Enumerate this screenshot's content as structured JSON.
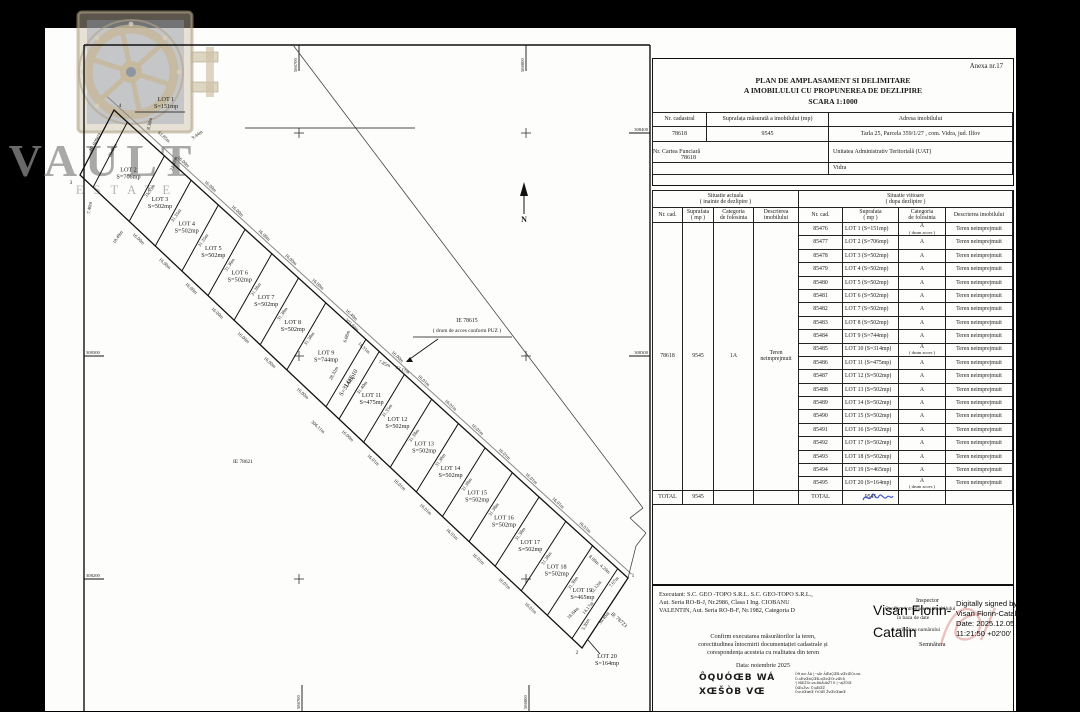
{
  "watermark": {
    "line1": "VAULT",
    "line2": "ESTATE"
  },
  "annex": "Anexa nr.17",
  "title": {
    "l1": "PLAN DE AMPLASAMENT SI DELIMITARE",
    "l2": "A IMOBILULUI CU PROPUNEREA DE DEZLIPIRE",
    "l3": "SCARA 1:1000"
  },
  "cadastral": {
    "h_nr": "Nr. cadastral",
    "h_sup": "Suprafața măsurată a imobilului (mp)",
    "h_adr": "Adresa imobilului",
    "nr": "78618",
    "sup": "9545",
    "adr": "Tarla 25,  Parcela 359/1/27 , com. Vidra, jud. Ilfov",
    "cf_label": "Nr. Cartea Funciară",
    "cf": "78618",
    "uat_label": "Unitatea Administrativ Teritorială (UAT)",
    "uat": "Vidra"
  },
  "table": {
    "actual_header": "Situatie actuala\n( inainte de dezlipire )",
    "future_header": "Situatie viitoare\n( dupa dezlipire )",
    "cols": [
      "Nr. cad.",
      "Suprafata\n( mp )",
      "Categoria\nde folosinta",
      "Descrierea imobilului"
    ],
    "actual": {
      "nr": "78618",
      "sup": "9545",
      "cat": "1A",
      "desc": "Teren neimprejmuit"
    },
    "rows": [
      {
        "nr": "85476",
        "lot": "LOT 1 (S=151mp)",
        "cat": "A",
        "cat2": "( drum acces )",
        "desc": "Teren neimprejmuit"
      },
      {
        "nr": "85477",
        "lot": "LOT 2 (S=706mp)",
        "cat": "A",
        "cat2": "",
        "desc": "Teren neimprejmuit"
      },
      {
        "nr": "85478",
        "lot": "LOT 3 (S=502mp)",
        "cat": "A",
        "cat2": "",
        "desc": "Teren neimprejmuit"
      },
      {
        "nr": "85479",
        "lot": "LOT 4 (S=502mp)",
        "cat": "A",
        "cat2": "",
        "desc": "Teren neimprejmuit"
      },
      {
        "nr": "85480",
        "lot": "LOT 5 (S=502mp)",
        "cat": "A",
        "cat2": "",
        "desc": "Teren neimprejmuit"
      },
      {
        "nr": "85481",
        "lot": "LOT 6 (S=502mp)",
        "cat": "A",
        "cat2": "",
        "desc": "Teren neimprejmuit"
      },
      {
        "nr": "85482",
        "lot": "LOT 7 (S=502mp)",
        "cat": "A",
        "cat2": "",
        "desc": "Teren neimprejmuit"
      },
      {
        "nr": "85483",
        "lot": "LOT 8 (S=502mp)",
        "cat": "A",
        "cat2": "",
        "desc": "Teren neimprejmuit"
      },
      {
        "nr": "85484",
        "lot": "LOT 9 (S=744mp)",
        "cat": "A",
        "cat2": "",
        "desc": "Teren neimprejmuit"
      },
      {
        "nr": "85485",
        "lot": "LOT 10 (S=314mp)",
        "cat": "A",
        "cat2": "( drum acces )",
        "desc": "Teren neimprejmuit"
      },
      {
        "nr": "85486",
        "lot": "LOT 11 (S=475mp)",
        "cat": "A",
        "cat2": "",
        "desc": "Teren neimprejmuit"
      },
      {
        "nr": "85487",
        "lot": "LOT 12 (S=502mp)",
        "cat": "A",
        "cat2": "",
        "desc": "Teren neimprejmuit"
      },
      {
        "nr": "85488",
        "lot": "LOT 13 (S=502mp)",
        "cat": "A",
        "cat2": "",
        "desc": "Teren neimprejmuit"
      },
      {
        "nr": "85489",
        "lot": "LOT 14 (S=502mp)",
        "cat": "A",
        "cat2": "",
        "desc": "Teren neimprejmuit"
      },
      {
        "nr": "85490",
        "lot": "LOT 15 (S=502mp)",
        "cat": "A",
        "cat2": "",
        "desc": "Teren neimprejmuit"
      },
      {
        "nr": "85491",
        "lot": "LOT 16 (S=502mp)",
        "cat": "A",
        "cat2": "",
        "desc": "Teren neimprejmuit"
      },
      {
        "nr": "85492",
        "lot": "LOT 17 (S=502mp)",
        "cat": "A",
        "cat2": "",
        "desc": "Teren neimprejmuit"
      },
      {
        "nr": "85493",
        "lot": "LOT 18 (S=502mp)",
        "cat": "A",
        "cat2": "",
        "desc": "Teren neimprejmuit"
      },
      {
        "nr": "85494",
        "lot": "LOT 19 (S=465mp)",
        "cat": "A",
        "cat2": "",
        "desc": "Teren neimprejmuit"
      },
      {
        "nr": "85495",
        "lot": "LOT 20 (S=164mp)",
        "cat": "A",
        "cat2": "( drum acces )",
        "desc": "Teren neimprejmuit"
      }
    ],
    "total_label": "TOTAL",
    "total_val": "9545",
    "stamp_color": "#2f48c0"
  },
  "footer": {
    "executant_lines": [
      "Executant: S.C. GEO -TOPO S.R.L.  S.C. GEO-TOPO S.R.L.,",
      "Aut. Seria RO-B-J, Nr.2986, Clasa I Ing. CIOBANU",
      "VALENTIN, Aut. Seria RO-B-F, Nr.1982, Categoria D"
    ],
    "confirm_lines": [
      "Confirm executarea măsurătorilor la teren,",
      "corectitudinea întocmirii documentației cadastrale și",
      "corespondența acesteia cu realitatea din teren"
    ],
    "date": "Data: noiembrie 2025",
    "stamp_big_1": "ÔQUÓŒB WÁ",
    "stamp_big_2": "XŒŠÒB VŒ",
    "stamp_small": "Ôft aur ÂA |~sÁr ÃŒaÇŒB-vŒcŒÒr-va-\nÔ-rÆvŒaÇŒB-vŒcŒÒr-vŒrÁ\n'| MŒŽÒr-va-BAÃUbŽT K |~aļŽÒŒ\nÔŒuŽvu ©uÆŒŽ\nÔur-tŒœŒ ŸrÒŒĺ ŽvŒrŒœŒ",
    "inspector_label": "Inspector",
    "insp_l1": "Confirm introducerea imobilului",
    "insp_l2": "în baza de date",
    "insp_l3": "și atribuirea numărului",
    "semnatura": "Semnătura",
    "sig_name_l1": "Visan Florin-",
    "sig_name_l2": "Catalin",
    "sig_details": "Digitally signed by\nVisan Florin-Catalin\nDate: 2025.12.05\n11:21:50 +02'00'"
  },
  "plan": {
    "frame": {
      "left": 84,
      "top": 45,
      "right": 650,
      "bottom": 711
    },
    "grid": {
      "crosses": [
        [
          299,
          133
        ],
        [
          526,
          133
        ],
        [
          299,
          356
        ],
        [
          526,
          356
        ],
        [
          299,
          579
        ],
        [
          526,
          579
        ]
      ],
      "left_ticks": [
        {
          "v": "308300",
          "y": 356
        },
        {
          "v": "308200",
          "y": 579
        }
      ],
      "right_ticks": [
        {
          "v": "308400",
          "y": 133
        },
        {
          "v": "308300",
          "y": 356
        }
      ],
      "top_ticks": [
        {
          "v": "586700",
          "x": 299
        },
        {
          "v": "586800",
          "x": 526
        }
      ],
      "bottom_ticks": [
        {
          "v": "586700",
          "x": 302
        },
        {
          "v": "586800",
          "x": 529
        }
      ]
    },
    "strip": {
      "p4": [
        114,
        110
      ],
      "p1": [
        628,
        578
      ],
      "p3": [
        80,
        175
      ],
      "p2": [
        582,
        648
      ],
      "fractions": [
        0,
        0.026,
        0.098,
        0.15,
        0.203,
        0.255,
        0.307,
        0.359,
        0.412,
        0.49,
        0.516,
        0.565,
        0.618,
        0.67,
        0.722,
        0.775,
        0.827,
        0.879,
        0.931,
        0.98,
        1
      ],
      "lots": [
        {
          "n": "LOT 1",
          "a": "S=151mp"
        },
        {
          "n": "LOT 2",
          "a": "S=706mp"
        },
        {
          "n": "LOT 3",
          "a": "S=502mp"
        },
        {
          "n": "LOT 4",
          "a": "S=502mp"
        },
        {
          "n": "LOT 5",
          "a": "S=502mp"
        },
        {
          "n": "LOT 6",
          "a": "S=502mp"
        },
        {
          "n": "LOT 7",
          "a": "S=502mp"
        },
        {
          "n": "LOT 8",
          "a": "S=502mp"
        },
        {
          "n": "LOT 9",
          "a": "S=744mp"
        },
        {
          "n": "LOT 10",
          "a": "S=314mp"
        },
        {
          "n": "LOT 11",
          "a": "S=475mp"
        },
        {
          "n": "LOT 12",
          "a": "S=502mp"
        },
        {
          "n": "LOT 13",
          "a": "S=502mp"
        },
        {
          "n": "LOT 14",
          "a": "S=502mp"
        },
        {
          "n": "LOT 15",
          "a": "S=502mp"
        },
        {
          "n": "LOT 16",
          "a": "S=502mp"
        },
        {
          "n": "LOT 17",
          "a": "S=502mp"
        },
        {
          "n": "LOT 18",
          "a": "S=502mp"
        },
        {
          "n": "LOT 19",
          "a": "S=465mp"
        },
        {
          "n": "LOT 20",
          "a": "S=164mp"
        }
      ],
      "overrides": {
        "0": {
          "x": 166,
          "y": 101
        },
        "9": {
          "rot": -58
        },
        "19": {
          "x": 607,
          "y": 658
        }
      },
      "road_vals": [
        "",
        "",
        "16.00m",
        "16.00m",
        "16.00m",
        "16.00m",
        "16.00m",
        "16.00m",
        "16.40m",
        "",
        "16.00m",
        "16.01m",
        "16.01m",
        "16.01m",
        "16.01m",
        "16.01m",
        "16.01m",
        "16.01m",
        "",
        ""
      ],
      "sw_vals": [
        "",
        "",
        "16.00m",
        "16.00m",
        "16.00m",
        "16.00m",
        "16.00m",
        "16.00m",
        "16.00m",
        "",
        "16.00m",
        "16.01m",
        "16.01m",
        "16.01m",
        "16.01m",
        "16.01m",
        "16.01m",
        "16.01m",
        "",
        ""
      ],
      "div_vals": [
        "",
        "31.35m",
        "31.35m",
        "31.35m",
        "31.36m",
        "31.38m",
        "31.38m",
        "31.38m",
        "",
        "31.40m",
        "31.35m",
        "31.38m",
        "31.38m",
        "31.38m",
        "31.38m",
        "31.38m",
        "31.38m",
        "31.38m",
        ""
      ]
    },
    "outer_line": [
      [
        293,
        45
      ],
      [
        643,
        508
      ],
      [
        630,
        518
      ],
      [
        646,
        533
      ],
      [
        636,
        546
      ],
      [
        628,
        578
      ]
    ],
    "lot1_underline": [
      [
        135,
        112
      ],
      [
        185,
        112
      ]
    ],
    "extra_line": [
      [
        245,
        128
      ],
      [
        415,
        128
      ]
    ],
    "lot20_leader": [
      [
        588,
        640
      ],
      [
        600,
        654
      ]
    ],
    "points": [
      {
        "v": "1",
        "x": 633,
        "y": 577
      },
      {
        "v": "2",
        "x": 577,
        "y": 654
      },
      {
        "v": "3",
        "x": 71,
        "y": 184
      },
      {
        "v": "4",
        "x": 120,
        "y": 107
      }
    ],
    "north": {
      "x": 524,
      "y": 198,
      "label": "N"
    },
    "callout": {
      "l1": "IE 78615",
      "l2": "( drum de acces conform PUZ )",
      "cx": 467,
      "cy": 322,
      "ux1": 413,
      "ux2": 512,
      "uy": 337,
      "ax": 438,
      "ay": 339,
      "tx": 407,
      "ty": 361
    },
    "texts": [
      {
        "v": "IE 60903",
        "x": 97,
        "y": 143,
        "r": -60
      },
      {
        "v": "20.49m",
        "x": 114,
        "y": 151,
        "r": -62
      },
      {
        "v": "8.38m",
        "x": 151,
        "y": 124,
        "r": -78
      },
      {
        "v": "9.44m",
        "x": 198,
        "y": 136,
        "r": -35
      },
      {
        "v": "21.45m",
        "x": 175,
        "y": 164,
        "r": -70
      },
      {
        "v": "61.85m",
        "x": 163,
        "y": 138,
        "r": 42
      },
      {
        "v": "7.40m",
        "x": 91,
        "y": 208,
        "r": -82
      },
      {
        "v": "18.49m",
        "x": 119,
        "y": 238,
        "r": -55
      },
      {
        "v": "303.84m",
        "x": 351,
        "y": 326,
        "r": 42
      },
      {
        "v": "18.31m",
        "x": 363,
        "y": 349,
        "r": 42
      },
      {
        "v": "6.08m",
        "x": 348,
        "y": 337,
        "r": -72
      },
      {
        "v": "28.32m",
        "x": 335,
        "y": 374,
        "r": -62
      },
      {
        "v": "7.85m",
        "x": 384,
        "y": 365,
        "r": 22
      },
      {
        "v": "13.17m",
        "x": 402,
        "y": 371,
        "r": 22
      },
      {
        "v": "306.11m",
        "x": 317,
        "y": 428,
        "r": 42
      },
      {
        "v": "IE 78621",
        "x": 243,
        "y": 463,
        "r": 0
      },
      {
        "v": "IE 78723",
        "x": 618,
        "y": 621,
        "r": 42
      },
      {
        "v": "8.00m",
        "x": 593,
        "y": 561,
        "r": 42
      },
      {
        "v": "4.20m",
        "x": 604,
        "y": 570,
        "r": 42
      },
      {
        "v": "32.12m",
        "x": 597,
        "y": 588,
        "r": -50
      },
      {
        "v": "7.67m",
        "x": 615,
        "y": 583,
        "r": -50
      },
      {
        "v": "30.40m",
        "x": 605,
        "y": 619,
        "r": -50
      },
      {
        "v": "14.17m",
        "x": 589,
        "y": 609,
        "r": -50
      },
      {
        "v": "18.84m",
        "x": 574,
        "y": 614,
        "r": -45
      },
      {
        "v": "5.30m",
        "x": 587,
        "y": 625,
        "r": -62
      }
    ]
  }
}
